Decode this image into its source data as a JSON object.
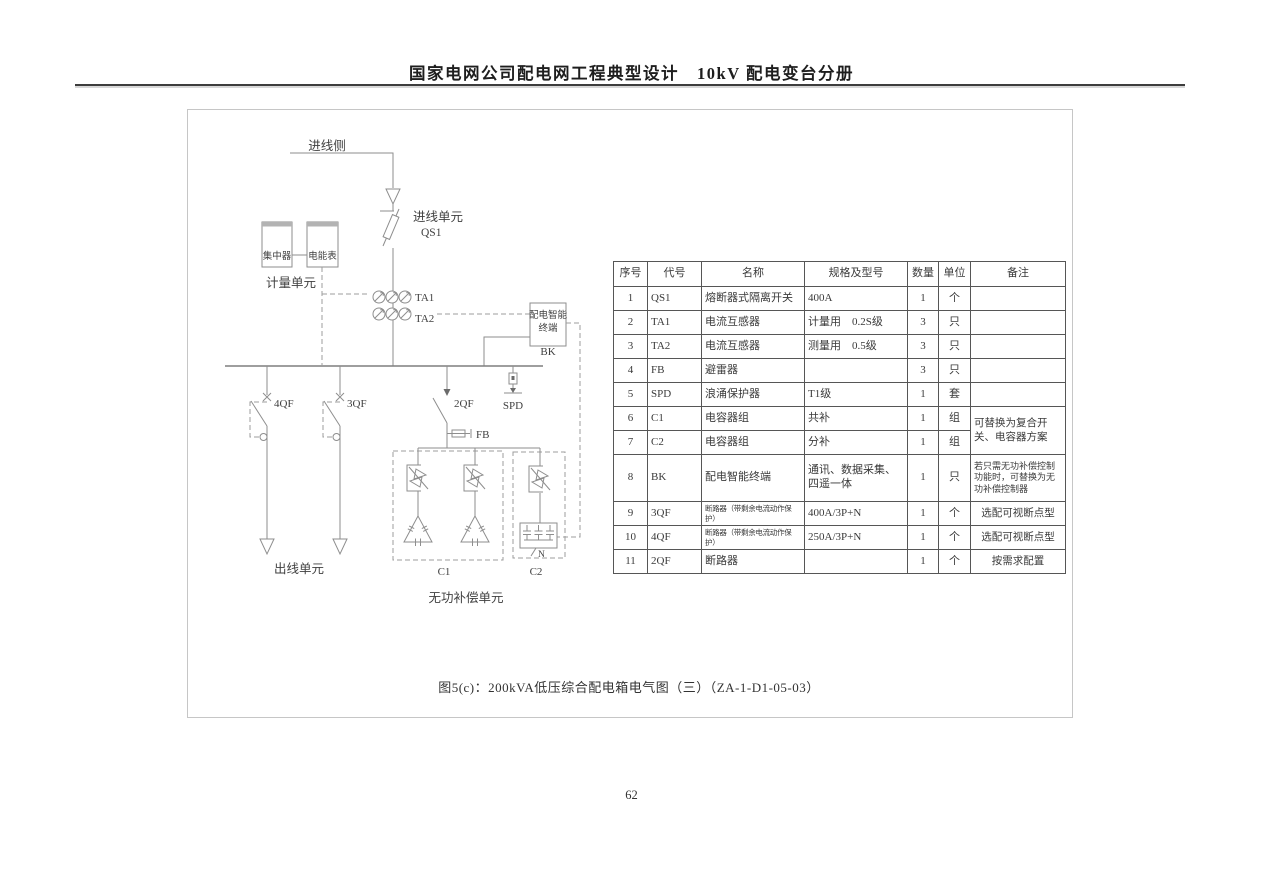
{
  "page": {
    "header_title": "国家电网公司配电网工程典型设计　10kV 配电变台分册",
    "caption": "图5(c)：200kVA低压综合配电箱电气图（三）（ZA-1-D1-05-03）",
    "page_number": "62"
  },
  "diagram": {
    "incoming_side": "进线侧",
    "incoming_unit": "进线单元",
    "qs1": "QS1",
    "concentrator": "集中器",
    "energy_meter": "电能表",
    "metering_unit": "计量单元",
    "ta1": "TA1",
    "ta2": "TA2",
    "terminal_name_line1": "配电智能",
    "terminal_name_line2": "终端",
    "bk": "BK",
    "qf4": "4QF",
    "qf3": "3QF",
    "qf2": "2QF",
    "spd": "SPD",
    "fb": "FB",
    "outgoing_unit": "出线单元",
    "c1": "C1",
    "c2": "C2",
    "neutral": "N",
    "reactive_compensation_unit": "无功补偿单元"
  },
  "table": {
    "headers": [
      "序号",
      "代号",
      "名称",
      "规格及型号",
      "数量",
      "单位",
      "备注"
    ],
    "rows": [
      {
        "no": "1",
        "code": "QS1",
        "name": "熔断器式隔离开关",
        "spec": "400A",
        "qty": "1",
        "unit": "个",
        "remark": ""
      },
      {
        "no": "2",
        "code": "TA1",
        "name": "电流互感器",
        "spec": "计量用　0.2S级",
        "qty": "3",
        "unit": "只",
        "remark": ""
      },
      {
        "no": "3",
        "code": "TA2",
        "name": "电流互感器",
        "spec": "测量用　0.5级",
        "qty": "3",
        "unit": "只",
        "remark": ""
      },
      {
        "no": "4",
        "code": "FB",
        "name": "避雷器",
        "spec": "",
        "qty": "3",
        "unit": "只",
        "remark": ""
      },
      {
        "no": "5",
        "code": "SPD",
        "name": "浪涌保护器",
        "spec": "T1级",
        "qty": "1",
        "unit": "套",
        "remark": ""
      },
      {
        "no": "6",
        "code": "C1",
        "name": "电容器组",
        "spec": "共补",
        "qty": "1",
        "unit": "组",
        "remark": "可替换为复合开关、电容器方案"
      },
      {
        "no": "7",
        "code": "C2",
        "name": "电容器组",
        "spec": "分补",
        "qty": "1",
        "unit": "组",
        "remark": ""
      },
      {
        "no": "8",
        "code": "BK",
        "name": "配电智能终端",
        "spec": "通讯、数据采集、四遥一体",
        "qty": "1",
        "unit": "只",
        "remark": "若只需无功补偿控制功能时，可替换为无功补偿控制器"
      },
      {
        "no": "9",
        "code": "3QF",
        "name": "断路器（带剩余电流动作保护）",
        "spec": "400A/3P+N",
        "qty": "1",
        "unit": "个",
        "remark": "选配可视断点型"
      },
      {
        "no": "10",
        "code": "4QF",
        "name": "断路器（带剩余电流动作保护）",
        "spec": "250A/3P+N",
        "qty": "1",
        "unit": "个",
        "remark": "选配可视断点型"
      },
      {
        "no": "11",
        "code": "2QF",
        "name": "断路器",
        "spec": "",
        "qty": "1",
        "unit": "个",
        "remark": "按需求配置"
      }
    ]
  }
}
